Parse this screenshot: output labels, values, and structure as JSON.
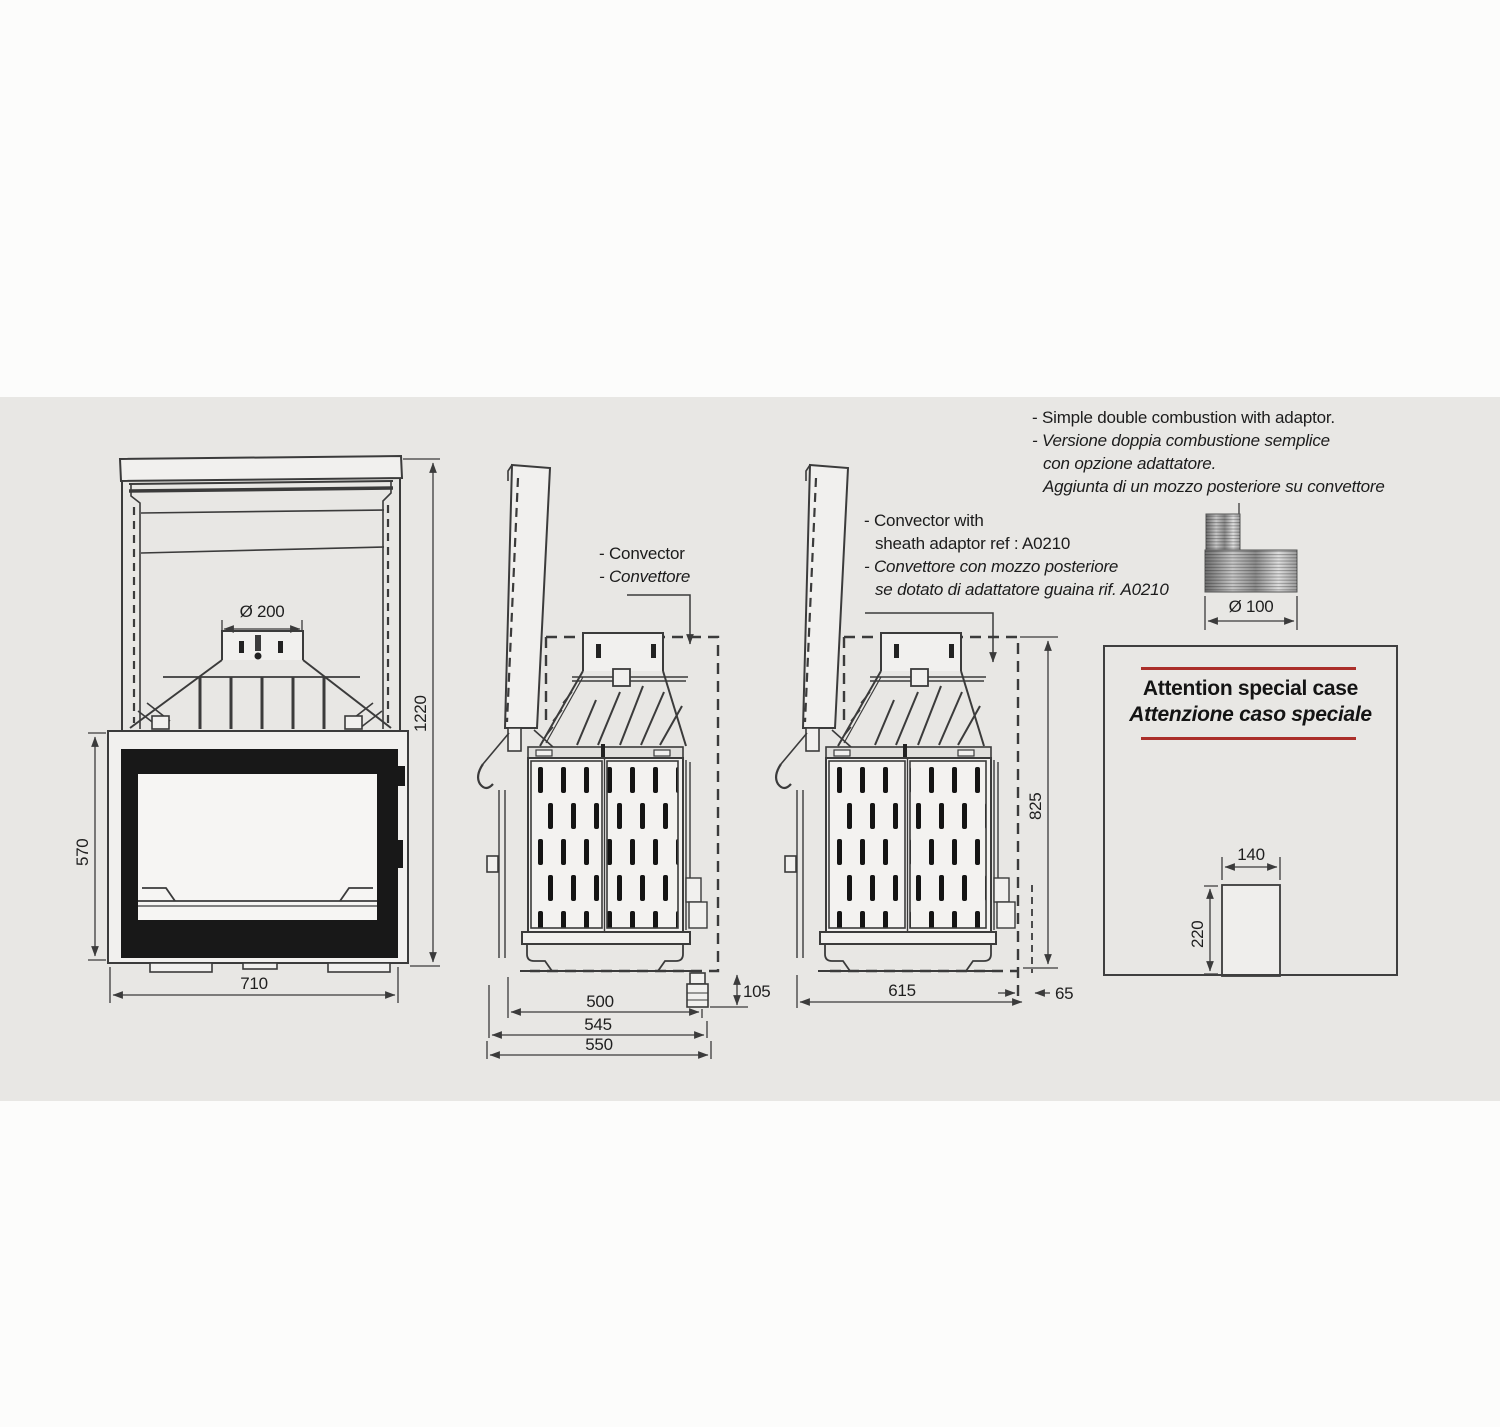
{
  "colors": {
    "page_bg": "#fcfcfb",
    "panel_bg": "#e8e7e4",
    "line": "#3b3b3b",
    "accent_red": "#ab2f2a",
    "door_black": "#181818"
  },
  "notes": {
    "combustion": {
      "en": "- Simple double combustion with adaptor.",
      "it1": "- Versione doppia combustione semplice",
      "it2": "con opzione adattatore.",
      "it3": "Aggiunta di un mozzo posteriore su convettore"
    },
    "convector": {
      "en": "- Convector",
      "it": "- Convettore"
    },
    "sheath": {
      "en1": "- Convector with",
      "en2": "sheath adaptor ref : A0210",
      "it1": "- Convettore con mozzo posteriore",
      "it2": "se dotato di adattatore guaina rif. A0210"
    },
    "attention": {
      "en": "Attention special case",
      "it": "Attenzione caso speciale"
    }
  },
  "dims": {
    "front": {
      "flue": "Ø 200",
      "height_total": "1220",
      "height_firebox": "570",
      "width": "710"
    },
    "side1": {
      "d500": "500",
      "d545": "545",
      "d550": "550",
      "d105": "105"
    },
    "side2": {
      "d615": "615",
      "d65": "65",
      "d825": "825"
    },
    "adaptor": {
      "dia": "Ø 100"
    },
    "special": {
      "w": "140",
      "h": "220"
    }
  }
}
